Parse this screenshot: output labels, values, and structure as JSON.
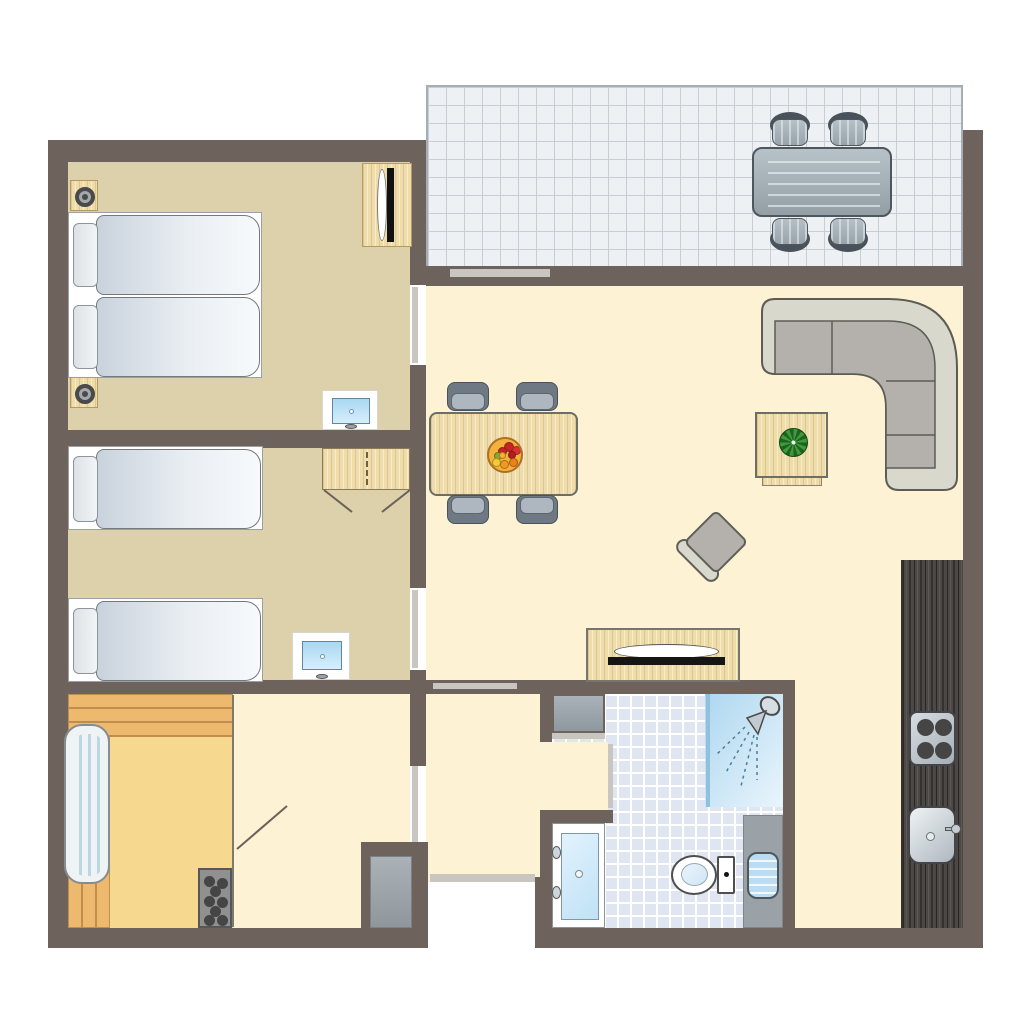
{
  "meta": {
    "title": "apartment-floor-plan"
  },
  "palette": {
    "wall": "#6d635c",
    "strip": "#c9c6c2",
    "tan": "#ddd1ab",
    "cream": "#fdf2d4",
    "saunafloor": "#f6d98e",
    "tile": "#eef1f4",
    "tilegrid": "#c7ced6",
    "wood": "#eedcab",
    "bench": "#ecb96e",
    "benchline": "#c08d4d",
    "sofaback": "#d9d8cd",
    "sofaseat": "#b4b1ad",
    "chairdark": "#6e7983",
    "chairseat": "#aeb7bf",
    "kitchen": "#4b4845",
    "blue": "#cfe9fa",
    "metal": "#b9c2c9"
  },
  "scene": [
    {
      "t": "terrace",
      "n": "terrace-floor",
      "r": [
        426,
        85,
        537,
        183
      ]
    },
    {
      "t": "floor",
      "n": "bedroom-1-floor",
      "r": [
        68,
        162,
        342,
        268
      ],
      "f": "tan"
    },
    {
      "t": "floor",
      "n": "bedroom-2-floor",
      "r": [
        68,
        448,
        342,
        232
      ],
      "f": "tan"
    },
    {
      "t": "floor",
      "n": "living-room-floor",
      "r": [
        426,
        286,
        537,
        642
      ],
      "f": "cream"
    },
    {
      "t": "floor",
      "n": "sauna-floor",
      "r": [
        68,
        694,
        165,
        234
      ],
      "f": "saunafloor"
    },
    {
      "t": "floor",
      "n": "sauna-anteroom-floor",
      "r": [
        233,
        694,
        177,
        234
      ],
      "f": "cream"
    },
    {
      "t": "bathtiles",
      "n": "bathroom-floor",
      "r": [
        552,
        694,
        231,
        234
      ]
    },
    {
      "t": "wall",
      "n": "wall-left",
      "r": [
        48,
        140,
        20,
        808
      ]
    },
    {
      "t": "wall",
      "n": "wall-top",
      "r": [
        48,
        140,
        378,
        22
      ]
    },
    {
      "t": "wall",
      "n": "wall-bottom-left",
      "r": [
        48,
        928,
        380,
        20
      ]
    },
    {
      "t": "wall",
      "n": "wall-bottom-right",
      "r": [
        535,
        928,
        448,
        20
      ]
    },
    {
      "t": "wall",
      "n": "wall-right",
      "r": [
        963,
        130,
        20,
        818
      ]
    },
    {
      "t": "wall",
      "n": "wall-terrace-living",
      "r": [
        426,
        266,
        557,
        20
      ]
    },
    {
      "t": "wall",
      "n": "wall-corridor-upper",
      "r": [
        410,
        162,
        16,
        123
      ]
    },
    {
      "t": "wall",
      "n": "wall-corridor-mid",
      "r": [
        410,
        365,
        16,
        223
      ]
    },
    {
      "t": "wall",
      "n": "wall-corridor-lower",
      "r": [
        410,
        670,
        16,
        96
      ]
    },
    {
      "t": "wall",
      "n": "wall-bedrooms-divider",
      "r": [
        48,
        430,
        378,
        18
      ]
    },
    {
      "t": "wall",
      "n": "wall-hall-band",
      "r": [
        48,
        680,
        747,
        14
      ]
    },
    {
      "t": "wall",
      "n": "wall-bath-left-upper",
      "r": [
        540,
        694,
        12,
        48
      ]
    },
    {
      "t": "wall",
      "n": "wall-bath-inner-corner",
      "r": [
        547,
        810,
        66,
        13
      ]
    },
    {
      "t": "wall",
      "n": "wall-hall-right-lower",
      "r": [
        540,
        810,
        12,
        118
      ]
    },
    {
      "t": "wall",
      "n": "wall-bathroom-right",
      "r": [
        783,
        680,
        12,
        248
      ]
    },
    {
      "t": "wall",
      "n": "wall-entrance-left",
      "r": [
        361,
        842,
        67,
        106
      ]
    },
    {
      "t": "wall",
      "n": "wall-entrance-right",
      "r": [
        535,
        877,
        17,
        51
      ]
    },
    {
      "t": "floor",
      "n": "bathroom-doorway-floor",
      "r": [
        540,
        742,
        68,
        68
      ],
      "f": "cream"
    },
    {
      "t": "white",
      "n": "entrance-door-opening",
      "r": [
        428,
        882,
        107,
        66
      ]
    },
    {
      "t": "strip",
      "n": "door-bedroom-1",
      "r": [
        412,
        287,
        6,
        76
      ]
    },
    {
      "t": "strip",
      "n": "door-bedroom-2",
      "r": [
        412,
        590,
        6,
        78
      ]
    },
    {
      "t": "strip",
      "n": "door-anteroom",
      "r": [
        412,
        766,
        6,
        76
      ]
    },
    {
      "t": "strip",
      "n": "door-bathroom",
      "r": [
        608,
        744,
        5,
        64
      ]
    },
    {
      "t": "strip",
      "n": "terrace-door-sill",
      "r": [
        450,
        269,
        100,
        8
      ]
    },
    {
      "t": "strip",
      "n": "hall-window-sill",
      "r": [
        433,
        683,
        84,
        6
      ]
    },
    {
      "t": "strip",
      "n": "entrance-threshold",
      "r": [
        430,
        874,
        105,
        8
      ]
    },
    {
      "t": "strip",
      "n": "utility-sill",
      "r": [
        552,
        733,
        53,
        6
      ]
    },
    {
      "t": "mat",
      "n": "entrance-mat",
      "r": [
        370,
        856,
        42,
        72
      ]
    },
    {
      "t": "nightstand",
      "n": "nightstand-top",
      "r": [
        70,
        180,
        28,
        31
      ]
    },
    {
      "t": "bed2",
      "n": "double-bed",
      "r": [
        68,
        212,
        194,
        166
      ]
    },
    {
      "t": "nightstand",
      "n": "nightstand-bottom",
      "r": [
        70,
        377,
        28,
        31
      ]
    },
    {
      "t": "deskmirror",
      "n": "dressing-table-mirror",
      "r": [
        362,
        163,
        50,
        84
      ]
    },
    {
      "t": "tv",
      "n": "tv-bedroom-1",
      "r": [
        322,
        390,
        56,
        40
      ]
    },
    {
      "t": "bed1",
      "n": "single-bed-1",
      "r": [
        68,
        446,
        195,
        84
      ]
    },
    {
      "t": "bed1",
      "n": "single-bed-2",
      "r": [
        68,
        598,
        195,
        84
      ]
    },
    {
      "t": "wardrobe",
      "n": "wardrobe",
      "r": [
        322,
        448,
        88,
        42
      ]
    },
    {
      "t": "tv",
      "n": "tv-bedroom-2",
      "r": [
        292,
        632,
        58,
        48
      ]
    },
    {
      "t": "benchh",
      "n": "sauna-bench-top",
      "r": [
        68,
        694,
        165,
        43
      ]
    },
    {
      "t": "benchv",
      "n": "sauna-bench-left",
      "r": [
        68,
        737,
        42,
        191
      ]
    },
    {
      "t": "lounger",
      "n": "sauna-lounger",
      "r": [
        64,
        724,
        46,
        160
      ]
    },
    {
      "t": "heater",
      "n": "sauna-heater",
      "r": [
        198,
        868,
        34,
        60
      ]
    },
    {
      "t": "dintable",
      "n": "dining-table",
      "r": [
        429,
        412,
        149,
        84
      ]
    },
    {
      "t": "dinchair",
      "n": "dining-chair-1",
      "r": [
        447,
        382,
        45,
        32
      ],
      "dir": "up"
    },
    {
      "t": "dinchair",
      "n": "dining-chair-2",
      "r": [
        516,
        382,
        45,
        32
      ],
      "dir": "up"
    },
    {
      "t": "dinchair",
      "n": "dining-chair-3",
      "r": [
        447,
        495,
        45,
        32
      ],
      "dir": "down"
    },
    {
      "t": "dinchair",
      "n": "dining-chair-4",
      "r": [
        516,
        495,
        45,
        32
      ],
      "dir": "down"
    },
    {
      "t": "fruit",
      "n": "fruit-bowl",
      "r": [
        487,
        437,
        36,
        36
      ]
    },
    {
      "t": "sofa",
      "n": "corner-sofa",
      "r": [
        755,
        295,
        205,
        205
      ]
    },
    {
      "t": "wood",
      "n": "coffee-table-base",
      "r": [
        762,
        470,
        60,
        16
      ],
      "bc": "#8d8265"
    },
    {
      "t": "coffee",
      "n": "coffee-table",
      "r": [
        755,
        412,
        73,
        66
      ]
    },
    {
      "t": "armchair",
      "n": "armchair",
      "r": [
        678,
        504,
        76,
        76
      ]
    },
    {
      "t": "sideboard",
      "n": "tv-sideboard",
      "r": [
        586,
        628,
        154,
        54
      ]
    },
    {
      "t": "kitchen",
      "n": "kitchen-counter",
      "r": [
        901,
        560,
        62,
        368
      ]
    },
    {
      "t": "stove",
      "n": "stove",
      "r": [
        909,
        711,
        47,
        55
      ]
    },
    {
      "t": "sink",
      "n": "kitchen-sink",
      "r": [
        908,
        806,
        48,
        58
      ]
    },
    {
      "t": "utility",
      "n": "utility-cabinet",
      "r": [
        552,
        694,
        53,
        39
      ]
    },
    {
      "t": "shower",
      "n": "shower",
      "r": [
        705,
        694,
        78,
        113
      ]
    },
    {
      "t": "vanity",
      "n": "bathroom-vanity",
      "r": [
        552,
        823,
        53,
        105
      ]
    },
    {
      "t": "toilet",
      "n": "toilet",
      "r": [
        671,
        853,
        68,
        44
      ]
    },
    {
      "t": "radiator",
      "n": "bathroom-radiator",
      "r": [
        743,
        815,
        40,
        113
      ]
    },
    {
      "t": "terrtable",
      "n": "terrace-table",
      "r": [
        752,
        147,
        140,
        70
      ]
    },
    {
      "t": "terrchair",
      "n": "terrace-chair-1",
      "r": [
        768,
        112,
        44,
        36
      ],
      "dir": "up"
    },
    {
      "t": "terrchair",
      "n": "terrace-chair-2",
      "r": [
        826,
        112,
        44,
        36
      ],
      "dir": "up"
    },
    {
      "t": "terrchair",
      "n": "terrace-chair-3",
      "r": [
        768,
        216,
        44,
        36
      ],
      "dir": "down"
    },
    {
      "t": "terrchair",
      "n": "terrace-chair-4",
      "r": [
        826,
        216,
        44,
        36
      ],
      "dir": "down"
    }
  ],
  "lines": {
    "door_swings": [
      [
        324,
        490,
        352,
        512
      ],
      [
        410,
        490,
        382,
        512
      ],
      [
        237,
        849,
        287,
        806
      ]
    ],
    "partitions": [
      [
        233,
        695,
        233,
        927
      ]
    ]
  },
  "fruits": [
    {
      "x": 15,
      "y": 3,
      "d": 10,
      "c": "#c42525"
    },
    {
      "x": 23,
      "y": 7,
      "d": 9,
      "c": "#d93030"
    },
    {
      "x": 9,
      "y": 8,
      "d": 9,
      "c": "#c42525"
    },
    {
      "x": 19,
      "y": 12,
      "d": 8,
      "c": "#b01f1f"
    },
    {
      "x": 5,
      "y": 13,
      "d": 8,
      "c": "#86a832"
    },
    {
      "x": 10,
      "y": 13,
      "d": 7,
      "c": "#f5b52b"
    },
    {
      "x": 3,
      "y": 19,
      "d": 9,
      "c": "#f0cd36"
    },
    {
      "x": 11,
      "y": 21,
      "d": 9,
      "c": "#ef9b20"
    },
    {
      "x": 20,
      "y": 19,
      "d": 9,
      "c": "#e8821a"
    }
  ],
  "heater_stones": [
    [
      4,
      6
    ],
    [
      17,
      8
    ],
    [
      10,
      16
    ],
    [
      4,
      26
    ],
    [
      17,
      27
    ],
    [
      10,
      36
    ],
    [
      4,
      45
    ],
    [
      17,
      45
    ]
  ]
}
